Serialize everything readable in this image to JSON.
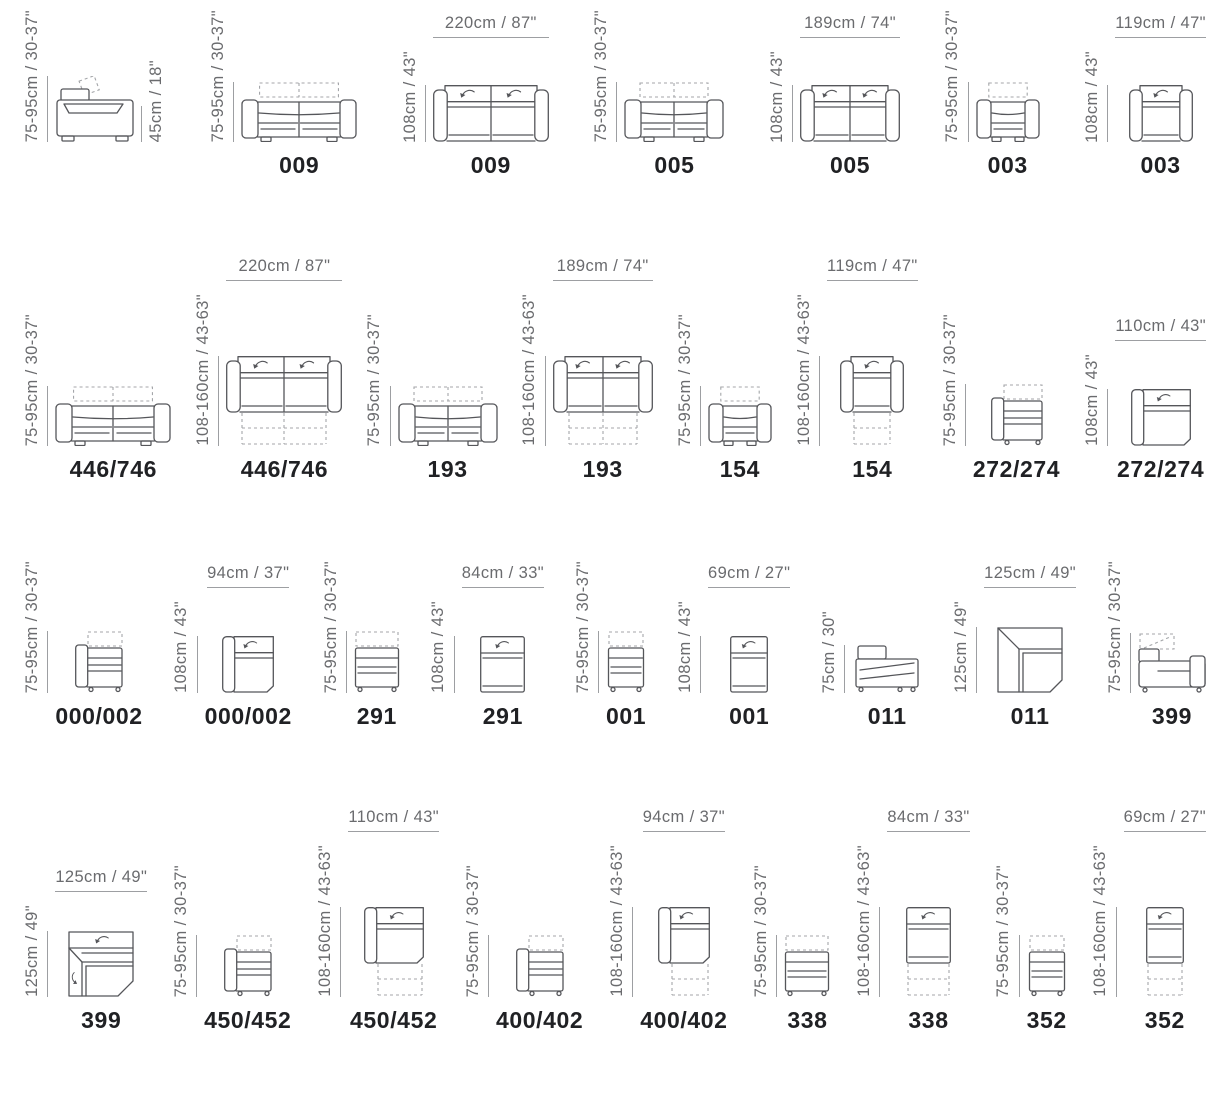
{
  "title": "Modular sofa dimension diagrams",
  "colors": {
    "background": "#ffffff",
    "furniture_line": "#55565a",
    "dimension_text": "#6a6b6e",
    "dimension_line": "#9d9fa2",
    "dashed_line": "#a4a6a9",
    "model_text": "#202124"
  },
  "rows": [
    {
      "items": [
        {
          "type": "side-sofa",
          "w": 80,
          "model": "",
          "v_dim": "75-95cm / 30-37\"",
          "extra_dim": "45cm / 18\""
        },
        {
          "type": "front-sofa",
          "w": 116,
          "model": "009",
          "v_dim": "75-95cm / 30-37\""
        },
        {
          "type": "top-sofa",
          "w": 116,
          "model": "009",
          "v_dim": "108cm / 43\"",
          "h_dim": "220cm / 87\""
        },
        {
          "type": "front-sofa",
          "w": 100,
          "model": "005",
          "v_dim": "75-95cm / 30-37\""
        },
        {
          "type": "top-sofa",
          "w": 100,
          "model": "005",
          "v_dim": "108cm / 43\"",
          "h_dim": "189cm / 74\""
        },
        {
          "type": "front-armchair",
          "w": 64,
          "model": "003",
          "v_dim": "75-95cm / 30-37\""
        },
        {
          "type": "top-armchair",
          "w": 64,
          "model": "003",
          "v_dim": "108cm / 43\"",
          "h_dim": "119cm / 47\""
        }
      ]
    },
    {
      "items": [
        {
          "type": "front-sofa",
          "w": 116,
          "model": "446/746",
          "v_dim": "75-95cm / 30-37\""
        },
        {
          "type": "top-sofa",
          "w": 116,
          "ext": true,
          "model": "446/746",
          "v_dim": "108-160cm / 43-63\"",
          "h_dim": "220cm / 87\""
        },
        {
          "type": "front-sofa",
          "w": 100,
          "model": "193",
          "v_dim": "75-95cm / 30-37\""
        },
        {
          "type": "top-sofa",
          "w": 100,
          "ext": true,
          "model": "193",
          "v_dim": "108-160cm / 43-63\"",
          "h_dim": "189cm / 74\""
        },
        {
          "type": "front-armchair",
          "w": 64,
          "model": "154",
          "v_dim": "75-95cm / 30-37\""
        },
        {
          "type": "top-armchair",
          "w": 64,
          "ext": true,
          "model": "154",
          "v_dim": "108-160cm / 43-63\"",
          "h_dim": "119cm / 47\""
        },
        {
          "type": "side-module",
          "w": 52,
          "model": "272/274",
          "v_dim": "75-95cm / 30-37\""
        },
        {
          "type": "top-module-arm",
          "w": 60,
          "model": "272/274",
          "v_dim": "108cm / 43\"",
          "h_dim": "110cm / 43\""
        }
      ]
    },
    {
      "items": [
        {
          "type": "side-module",
          "w": 48,
          "model": "000/002",
          "v_dim": "75-95cm / 30-37\""
        },
        {
          "type": "top-module-arm",
          "w": 52,
          "model": "000/002",
          "v_dim": "108cm / 43\"",
          "h_dim": "94cm / 37\""
        },
        {
          "type": "front-module",
          "w": 46,
          "model": "291",
          "v_dim": "75-95cm / 30-37\""
        },
        {
          "type": "top-module",
          "w": 45,
          "model": "291",
          "v_dim": "108cm / 43\"",
          "h_dim": "84cm / 33\""
        },
        {
          "type": "front-module",
          "w": 38,
          "model": "001",
          "v_dim": "75-95cm / 30-37\""
        },
        {
          "type": "top-module",
          "w": 38,
          "model": "001",
          "v_dim": "108cm / 43\"",
          "h_dim": "69cm / 27\""
        },
        {
          "type": "side-corner",
          "w": 70,
          "model": "011",
          "v_dim": "75cm / 30\""
        },
        {
          "type": "top-corner",
          "w": 66,
          "model": "011",
          "v_dim": "125cm / 49\"",
          "h_dim": "125cm / 49\""
        },
        {
          "type": "side-chaise",
          "w": 68,
          "model": "399",
          "v_dim": "75-95cm / 30-37\""
        }
      ]
    },
    {
      "items": [
        {
          "type": "top-corner-chaise",
          "w": 66,
          "model": "399",
          "v_dim": "125cm / 49\"",
          "h_dim": "125cm / 49\""
        },
        {
          "type": "side-module",
          "w": 48,
          "model": "450/452",
          "v_dim": "75-95cm / 30-37\""
        },
        {
          "type": "top-module-arm",
          "w": 60,
          "ext": true,
          "model": "450/452",
          "v_dim": "108-160cm / 43-63\"",
          "h_dim": "110cm / 43\""
        },
        {
          "type": "side-module",
          "w": 48,
          "model": "400/402",
          "v_dim": "75-95cm / 30-37\""
        },
        {
          "type": "top-module-arm",
          "w": 52,
          "ext": true,
          "model": "400/402",
          "v_dim": "108-160cm / 43-63\"",
          "h_dim": "94cm / 37\""
        },
        {
          "type": "front-module",
          "w": 46,
          "model": "338",
          "v_dim": "75-95cm / 30-37\""
        },
        {
          "type": "top-module",
          "w": 45,
          "ext": true,
          "model": "338",
          "v_dim": "108-160cm / 43-63\"",
          "h_dim": "84cm / 33\""
        },
        {
          "type": "front-module",
          "w": 38,
          "model": "352",
          "v_dim": "75-95cm / 30-37\""
        },
        {
          "type": "top-module",
          "w": 38,
          "ext": true,
          "model": "352",
          "v_dim": "108-160cm / 43-63\"",
          "h_dim": "69cm / 27\""
        }
      ]
    }
  ]
}
